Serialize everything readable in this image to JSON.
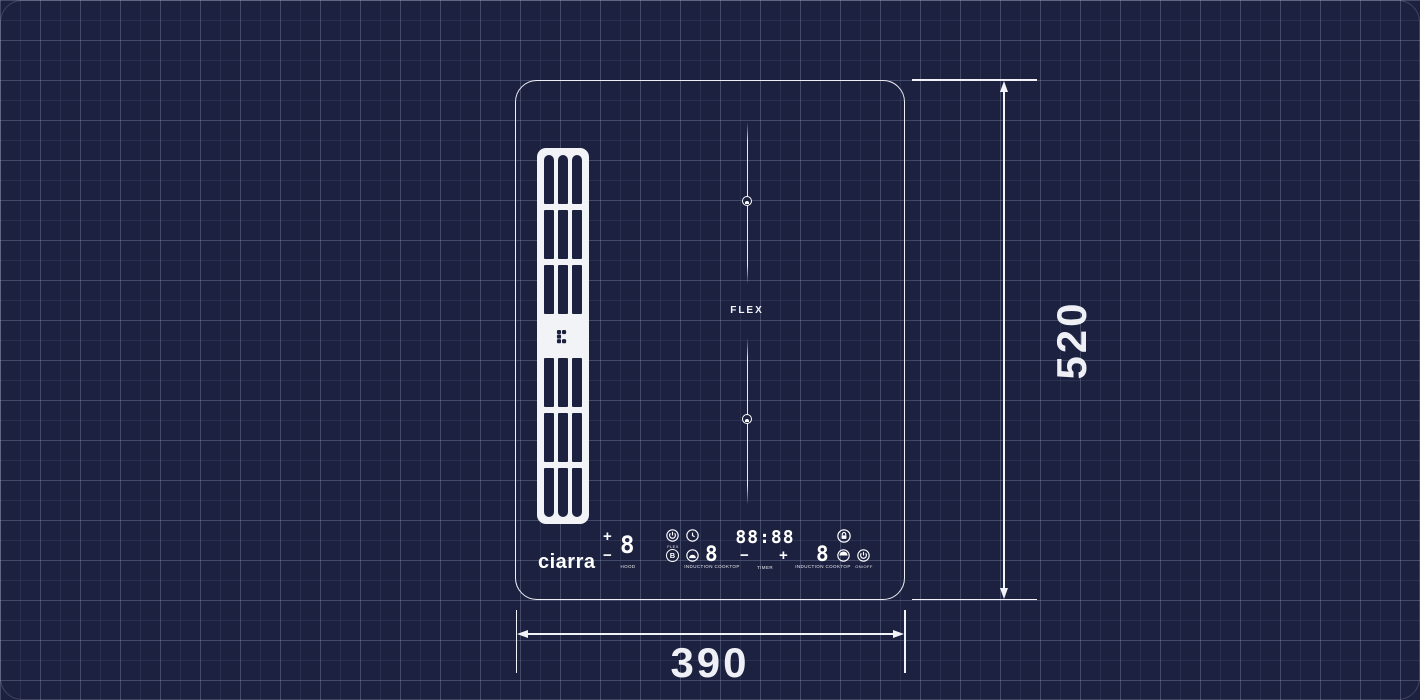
{
  "page": {
    "bg": "#1c2140",
    "grid_color": "rgba(168,178,214,0.2)",
    "stroke": "#f2f3f7"
  },
  "brand": {
    "logo_text": "ciarra"
  },
  "hob": {
    "flex_label": "FLEX"
  },
  "controls": {
    "hood": {
      "plus": "+",
      "minus": "−",
      "level": "8",
      "label": "HOOD"
    },
    "left_cluster": {
      "power_label": "FLEX",
      "boost_glyph": "B"
    },
    "left_zone": {
      "level": "8",
      "label": "INDUCTION COOKTOP"
    },
    "timer": {
      "display": "88:88",
      "minus": "−",
      "plus": "+",
      "label": "TIMER"
    },
    "right_zone": {
      "level": "8",
      "label": "INDUCTION COOKTOP"
    },
    "right_cluster": {
      "power_label": "ON/OFF"
    }
  },
  "dimensions": {
    "height": "520",
    "width": "390"
  },
  "icons": [
    "power-icon",
    "timer-clock-icon",
    "boost-icon",
    "keep-warm-icon",
    "lock-icon",
    "pause-icon",
    "pot-marker-icon",
    "ciarra-mark-icon"
  ]
}
